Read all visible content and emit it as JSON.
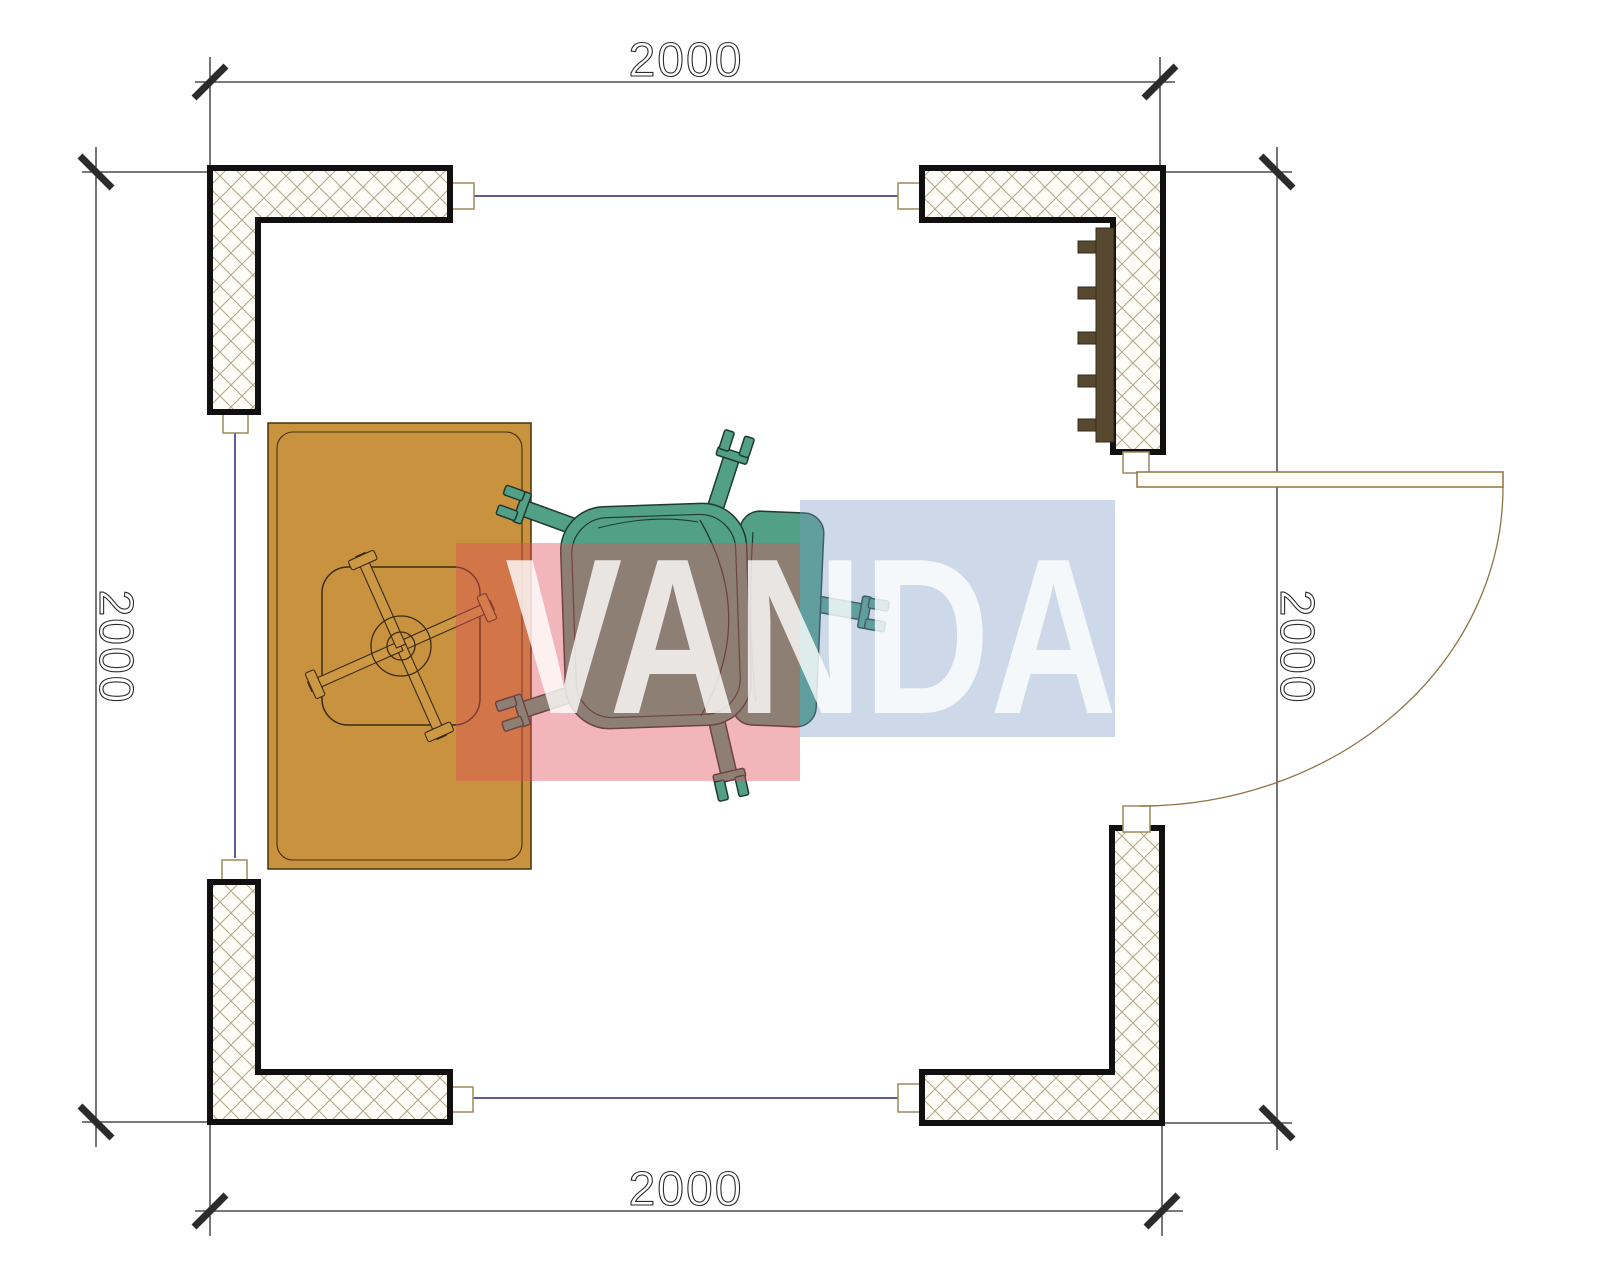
{
  "page": {
    "background": "#ffffff",
    "type": "architectural-floor-plan"
  },
  "dimensions": {
    "top_label": "2000",
    "bottom_label": "2000",
    "left_label": "2000",
    "right_label": "2000"
  },
  "watermark": {
    "text": "VANDA",
    "red_block_color": "rgba(224,81,91,0.42)",
    "blue_block_color": "rgba(123,155,197,0.38)",
    "text_color": "rgba(255,255,255,0.8)"
  },
  "colors": {
    "desk": "#c8923f",
    "stool_spoke": "#cd9843",
    "chair": "#52a086",
    "radiator": "#564930",
    "door": "#8d7443",
    "window_line": "#23237d",
    "connector_border": "#9b8a5a",
    "wall_hatch_line": "#b5a78a",
    "wall_outline": "#101010",
    "dimension_line": "#2b2b2b"
  }
}
